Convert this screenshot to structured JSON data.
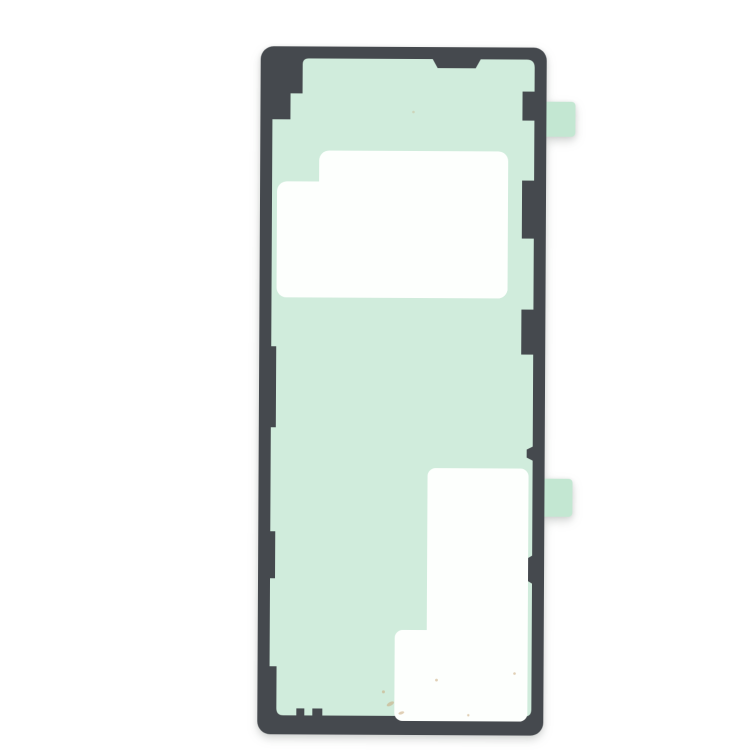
{
  "photo": {
    "alt": "Product photo of a smartphone back cover adhesive sticker: a tall rounded-rectangle dark grey gasket frame filled with mint green adhesive film, a large white rectangular cutout in the upper half, an L-shaped white cutout in the lower right, and two small mint green pull tabs protruding from the right edge",
    "background_color": "#ffffff"
  },
  "colors": {
    "background": "#ffffff",
    "frame": "#45494e",
    "adhesive": "#d0ecdc",
    "adhesive_tab": "#c3e7d2",
    "cutout": "#fdfffd",
    "stain": "#c9a87a"
  }
}
